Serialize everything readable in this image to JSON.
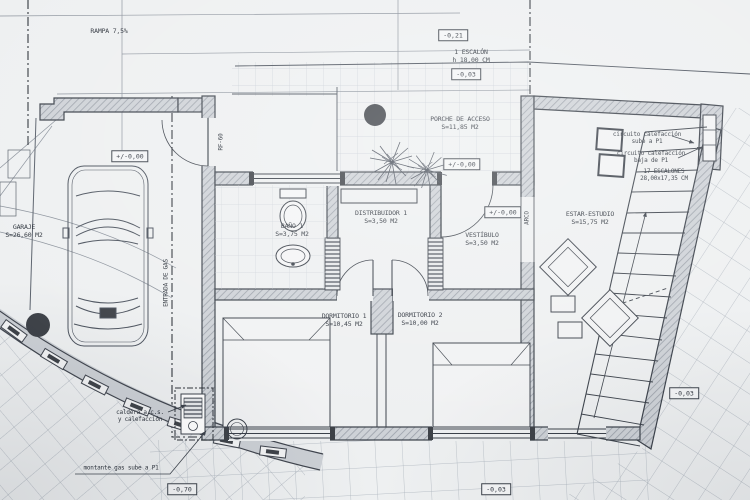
{
  "sheet": {
    "type": "architectural-floor-plan",
    "rooms": {
      "garaje": {
        "name": "GARAJE",
        "area": "S=26,60 M2"
      },
      "porche": {
        "name": "PORCHE DE ACCESO",
        "area": "S=11,85 M2"
      },
      "bano": {
        "name": "BAÑO 1",
        "area": "S=3,75 M2"
      },
      "distribuidor": {
        "name": "DISTRIBUIDOR 1",
        "area": "S=3,50 M2"
      },
      "vestibulo": {
        "name": "VESTÍBULO",
        "area": "S=3,50 M2"
      },
      "dormitorio1": {
        "name": "DORMITORIO 1",
        "area": "S=10,45 M2"
      },
      "dormitorio2": {
        "name": "DORMITORIO 2",
        "area": "S=10,00 M2"
      },
      "estar": {
        "name": "ESTAR-ESTUDIO",
        "area": "S=15,75 M2"
      }
    },
    "levels": {
      "ramp": "-0,21",
      "top_terrace": "-0,03",
      "porch": "+/-0,00",
      "garage": "+/-0,00",
      "vestibule": "+/-0,00",
      "right_terrace": "-0,03",
      "bottom_terrace": "-0,03",
      "lower_garden": "-0,70"
    },
    "annotations": {
      "rampa": "RAMPA 7,5%",
      "escalon_line1": "1 ESCALÓN",
      "escalon_line2": "h 18,00 CM",
      "circuito_sube_line1": "circuito calefacción",
      "circuito_sube_line2": "sube a P1",
      "circuito_baja_line1": "circuito calefacción",
      "circuito_baja_line2": "baja de P1",
      "escalones_line1": "17 ESCALONES",
      "escalones_line2": "28,00x17,35 CM",
      "rf60": "RF-60",
      "arco": "ARCO",
      "entrada_gas": "ENTRADA DE GAS",
      "caldera_line1": "caldera a.c.s.",
      "caldera_line2": "y calefacción",
      "montante": "montante gas sube a P1"
    },
    "colors": {
      "paper": "#eef0f1",
      "ink": "#3a4049",
      "wall_fill": "#ced2d7",
      "grid": "#c6ccd4",
      "dark_marker": "#3d4147"
    }
  }
}
